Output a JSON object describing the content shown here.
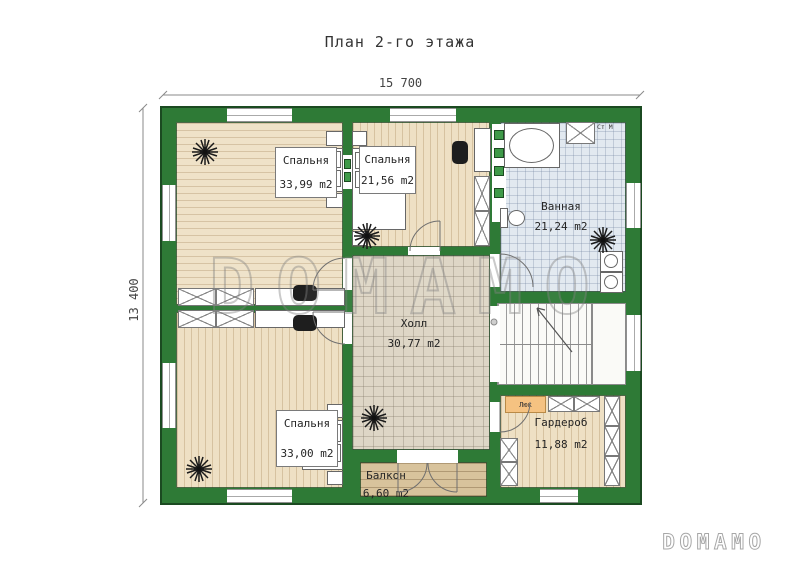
{
  "title": "План 2-го этажа",
  "dimensions": {
    "width": "15 700",
    "height": "13 400"
  },
  "rooms": {
    "bedroom1": {
      "name": "Спальня",
      "area": "33,99 m2"
    },
    "bedroom2": {
      "name": "Спальня",
      "area": "21,56 m2"
    },
    "bathroom": {
      "name": "Ванная",
      "area": "21,24 m2"
    },
    "hall": {
      "name": "Холл",
      "area": "30,77 m2"
    },
    "bedroom3": {
      "name": "Спальня",
      "area": "33,00 m2"
    },
    "wardrobe": {
      "name": "Гардероб",
      "area": "11,88 m2"
    },
    "balcony": {
      "name": "Балкон",
      "area": "6,60 m2"
    }
  },
  "annotations": {
    "hatch": "Люк",
    "washing_machine": "Ст М"
  },
  "watermark": {
    "center": "DOMAMO",
    "corner": "DOMAMO"
  },
  "colors": {
    "wall_green": "#2e7a36",
    "wall_edge": "#1b4a21",
    "wood_light": "#efe2c8",
    "tile_hall": "#ded6c6",
    "tile_bath": "#e2e9f0",
    "deck": "#d8c39c",
    "hatch_orange": "#f5c281"
  }
}
